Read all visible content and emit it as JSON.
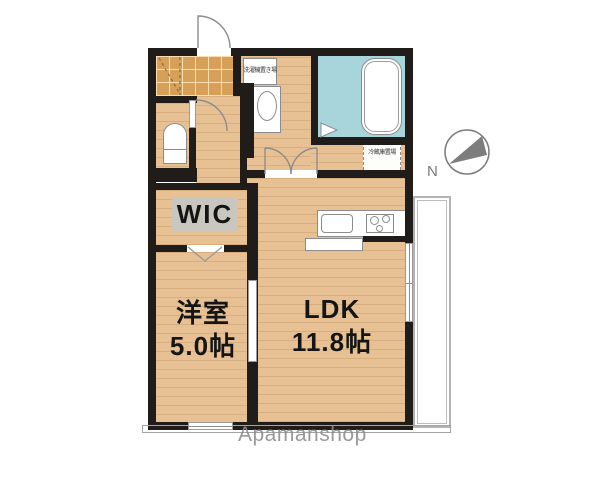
{
  "rooms": {
    "wic": {
      "label": "WIC"
    },
    "western_room": {
      "name": "洋室",
      "area": "5.0帖"
    },
    "ldk": {
      "name": "LDK",
      "area": "11.8帖"
    }
  },
  "fixtures": {
    "washer_label": "洗濯機置き場",
    "fridge_label": "冷蔵庫置場"
  },
  "compass": {
    "north_label": "N"
  },
  "watermark": {
    "text": "Apamanshop"
  },
  "colors": {
    "wall": "#201c19",
    "wood": "#e7c193",
    "tile": "#d7a058",
    "bath_floor": "#a8d4dc",
    "wic_label_bg": "#c9c6bf",
    "watermark_gray": "#8f8f8f"
  }
}
